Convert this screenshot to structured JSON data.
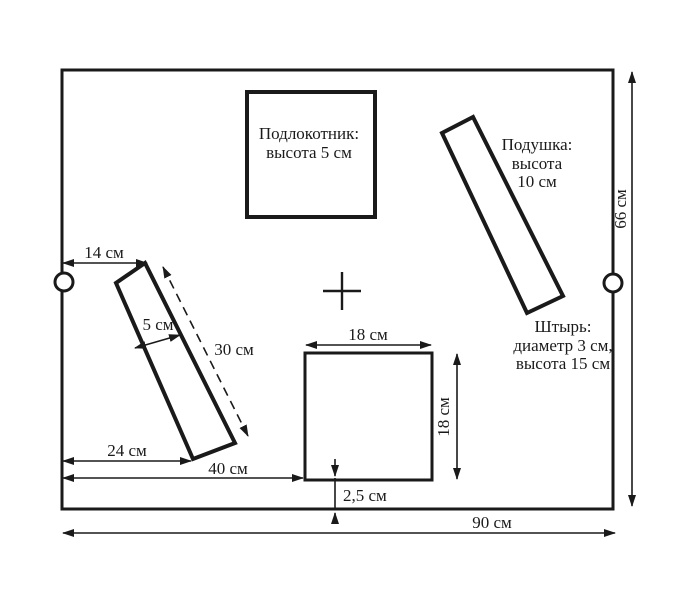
{
  "diagram": {
    "armrest_label": {
      "line1": "Подлокотник:",
      "line2": "высота 5 см"
    },
    "pillow_label": {
      "line1": "Подушка:",
      "line2": "высота",
      "line3": "10 см"
    },
    "pin_label": {
      "line1": "Штырь:",
      "line2": "диаметр 3 см,",
      "line3": "высота 15 см"
    },
    "dims": {
      "left_pin_offset": "14 см",
      "strip_width": "5 см",
      "strip_length": "30 см",
      "strip_bottom_offset": "24 см",
      "square_left_offset": "40 см",
      "square_width": "18 см",
      "square_height": "18 см",
      "square_bottom_gap": "2,5 см",
      "board_height": "66 см",
      "board_width": "90 см"
    },
    "colors": {
      "line": "#1a1a1a",
      "background": "#ffffff"
    }
  }
}
